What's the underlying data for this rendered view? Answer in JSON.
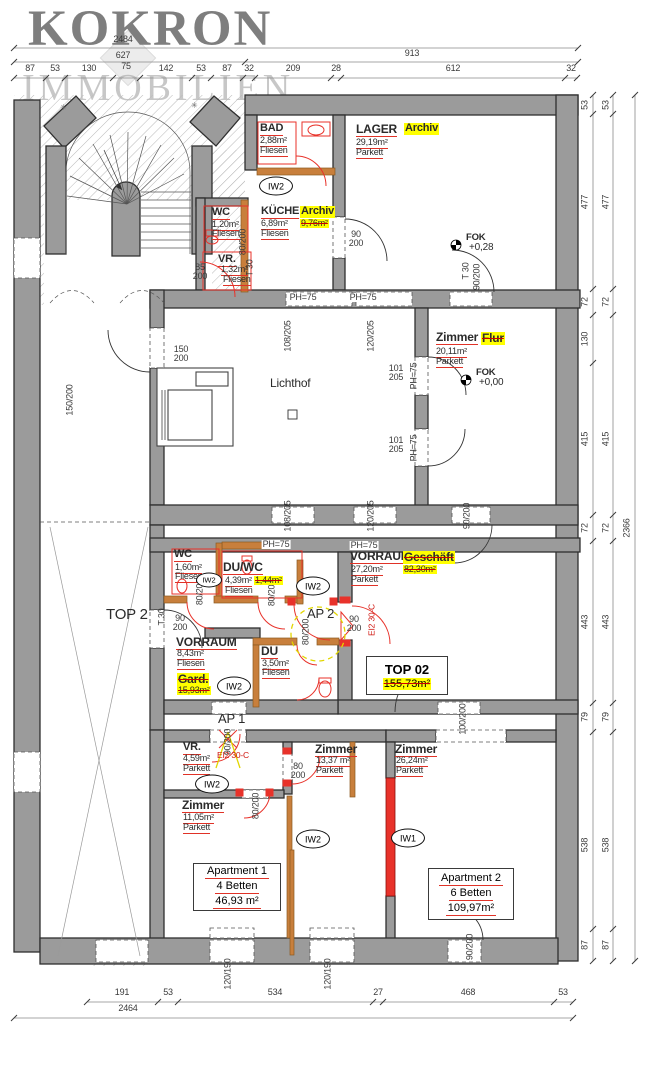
{
  "watermark": {
    "title": "KOKRON",
    "subtitle": "IMMOBILIEN"
  },
  "plan": {
    "colors": {
      "accent_red": "#e03227",
      "highlight_yellow": "#ffff00",
      "wall_gray": "#9b9b9b",
      "orange_wall": "#c87f3c"
    },
    "labels": [
      {
        "n": "dim-total-top",
        "t": "2484",
        "x": 123,
        "y": 35,
        "c": "d"
      },
      {
        "t": "627",
        "x": 123,
        "y": 51,
        "c": "d"
      },
      {
        "t": "913",
        "x": 412,
        "y": 49,
        "c": "d"
      },
      {
        "t": "87",
        "x": 30,
        "y": 64,
        "c": "d"
      },
      {
        "t": "53",
        "x": 55,
        "y": 64,
        "c": "d"
      },
      {
        "t": "130",
        "x": 89,
        "y": 64,
        "c": "d"
      },
      {
        "t": "75",
        "x": 126,
        "y": 62,
        "c": "d"
      },
      {
        "t": "142",
        "x": 166,
        "y": 64,
        "c": "d"
      },
      {
        "t": "53",
        "x": 201,
        "y": 64,
        "c": "d"
      },
      {
        "t": "87",
        "x": 227,
        "y": 64,
        "c": "d"
      },
      {
        "t": "32",
        "x": 249,
        "y": 64,
        "c": "d"
      },
      {
        "t": "209",
        "x": 293,
        "y": 64,
        "c": "d"
      },
      {
        "t": "28",
        "x": 336,
        "y": 64,
        "c": "d"
      },
      {
        "t": "612",
        "x": 453,
        "y": 64,
        "c": "d"
      },
      {
        "t": "32",
        "x": 571,
        "y": 64,
        "c": "d"
      },
      {
        "t": "53",
        "x": 585,
        "y": 105,
        "c": "d",
        "r": -90
      },
      {
        "t": "477",
        "x": 585,
        "y": 202,
        "c": "d",
        "r": -90
      },
      {
        "t": "72",
        "x": 585,
        "y": 302,
        "c": "d",
        "r": -90
      },
      {
        "t": "130",
        "x": 585,
        "y": 339,
        "c": "d",
        "r": -90
      },
      {
        "t": "415",
        "x": 585,
        "y": 439,
        "c": "d",
        "r": -90
      },
      {
        "t": "72",
        "x": 585,
        "y": 528,
        "c": "d",
        "r": -90
      },
      {
        "t": "443",
        "x": 585,
        "y": 622,
        "c": "d",
        "r": -90
      },
      {
        "t": "79",
        "x": 585,
        "y": 717,
        "c": "d",
        "r": -90
      },
      {
        "t": "538",
        "x": 585,
        "y": 845,
        "c": "d",
        "r": -90
      },
      {
        "t": "87",
        "x": 585,
        "y": 945,
        "c": "d",
        "r": -90
      },
      {
        "t": "53",
        "x": 606,
        "y": 105,
        "c": "d",
        "r": -90
      },
      {
        "t": "477",
        "x": 606,
        "y": 202,
        "c": "d",
        "r": -90
      },
      {
        "t": "72",
        "x": 606,
        "y": 302,
        "c": "d",
        "r": -90
      },
      {
        "t": "415",
        "x": 606,
        "y": 439,
        "c": "d",
        "r": -90
      },
      {
        "t": "72",
        "x": 606,
        "y": 528,
        "c": "d",
        "r": -90
      },
      {
        "t": "443",
        "x": 606,
        "y": 622,
        "c": "d",
        "r": -90
      },
      {
        "t": "79",
        "x": 606,
        "y": 717,
        "c": "d",
        "r": -90
      },
      {
        "t": "538",
        "x": 606,
        "y": 845,
        "c": "d",
        "r": -90
      },
      {
        "t": "87",
        "x": 606,
        "y": 945,
        "c": "d",
        "r": -90
      },
      {
        "n": "dim-total-right",
        "t": "2366",
        "x": 627,
        "y": 528,
        "c": "d",
        "r": -90
      },
      {
        "t": "191",
        "x": 122,
        "y": 988,
        "c": "d"
      },
      {
        "t": "53",
        "x": 168,
        "y": 988,
        "c": "d"
      },
      {
        "t": "534",
        "x": 275,
        "y": 988,
        "c": "d"
      },
      {
        "t": "27",
        "x": 378,
        "y": 988,
        "c": "d"
      },
      {
        "t": "468",
        "x": 468,
        "y": 988,
        "c": "d"
      },
      {
        "t": "53",
        "x": 563,
        "y": 988,
        "c": "d"
      },
      {
        "n": "dim-total-bottom",
        "t": "2464",
        "x": 128,
        "y": 1004,
        "c": "d"
      },
      {
        "t": "120/190",
        "x": 228,
        "y": 974,
        "c": "d",
        "r": -90
      },
      {
        "t": "120/190",
        "x": 328,
        "y": 974,
        "c": "d",
        "r": -90
      },
      {
        "t": "90/200",
        "x": 470,
        "y": 947,
        "c": "d",
        "r": -90
      },
      {
        "t": "80/200",
        "x": 243,
        "y": 242,
        "c": "d",
        "r": -90
      },
      {
        "t": "85\n200",
        "x": 200,
        "y": 263,
        "c": "d2"
      },
      {
        "t": "T 30",
        "x": 250,
        "y": 268,
        "c": "d",
        "r": -90
      },
      {
        "t": "90\n200",
        "x": 356,
        "y": 230,
        "c": "d2"
      },
      {
        "t": "T 30",
        "x": 466,
        "y": 271,
        "c": "d",
        "r": -90
      },
      {
        "t": "90/200",
        "x": 477,
        "y": 277,
        "c": "d",
        "r": -90
      },
      {
        "t": "150\n200",
        "x": 181,
        "y": 345,
        "c": "d2"
      },
      {
        "t": "150/200",
        "x": 70,
        "y": 400,
        "c": "d",
        "r": -90
      },
      {
        "t": "PH=75",
        "x": 303,
        "y": 293,
        "c": "ph"
      },
      {
        "t": "PH=75",
        "x": 363,
        "y": 293,
        "c": "ph"
      },
      {
        "t": "108/205",
        "x": 288,
        "y": 336,
        "c": "d",
        "r": -90
      },
      {
        "t": "120/205",
        "x": 371,
        "y": 336,
        "c": "d",
        "r": -90
      },
      {
        "t": "101\n205",
        "x": 396,
        "y": 364,
        "c": "d2"
      },
      {
        "t": "PH=75",
        "x": 414,
        "y": 376,
        "c": "d",
        "r": -90
      },
      {
        "t": "101\n205",
        "x": 396,
        "y": 436,
        "c": "d2"
      },
      {
        "t": "PH=75",
        "x": 414,
        "y": 448,
        "c": "d",
        "r": -90
      },
      {
        "t": "108/205",
        "x": 288,
        "y": 516,
        "c": "d",
        "r": -90
      },
      {
        "t": "120/205",
        "x": 371,
        "y": 516,
        "c": "d",
        "r": -90
      },
      {
        "t": "90/200",
        "x": 467,
        "y": 516,
        "c": "d",
        "r": -90
      },
      {
        "t": "PH=75",
        "x": 276,
        "y": 540,
        "c": "ph"
      },
      {
        "t": "PH=75",
        "x": 364,
        "y": 541,
        "c": "ph"
      },
      {
        "t": "80/200",
        "x": 200,
        "y": 592,
        "c": "d",
        "r": -90
      },
      {
        "t": "80/200",
        "x": 272,
        "y": 593,
        "c": "d",
        "r": -90
      },
      {
        "t": "90\n200",
        "x": 354,
        "y": 615,
        "c": "d2"
      },
      {
        "t": "EI2 30-C",
        "x": 372,
        "y": 620,
        "c": "red",
        "r": -90
      },
      {
        "t": "90\n200",
        "x": 180,
        "y": 614,
        "c": "d2"
      },
      {
        "t": "T 30",
        "x": 162,
        "y": 617,
        "c": "d",
        "r": -90
      },
      {
        "t": "80/200",
        "x": 306,
        "y": 632,
        "c": "d",
        "r": -90
      },
      {
        "t": "100/200",
        "x": 463,
        "y": 719,
        "c": "d",
        "r": -90
      },
      {
        "t": "90/200",
        "x": 228,
        "y": 742,
        "c": "d",
        "r": -90
      },
      {
        "t": "EI2 30-C",
        "x": 233,
        "y": 751,
        "c": "redh"
      },
      {
        "t": "80\n200",
        "x": 298,
        "y": 762,
        "c": "d2"
      },
      {
        "t": "80/200",
        "x": 256,
        "y": 806,
        "c": "d",
        "r": -90
      },
      {
        "n": "room-bad-name",
        "t": "BAD",
        "x": 260,
        "y": 123,
        "c": "rm"
      },
      {
        "t": "2,88m²",
        "x": 260,
        "y": 136,
        "c": "rs"
      },
      {
        "t": "Fliesen",
        "x": 260,
        "y": 146,
        "c": "rs"
      },
      {
        "n": "room-lager-name",
        "t": "LAGER",
        "x": 356,
        "y": 123,
        "c": "rm12"
      },
      {
        "n": "room-lager-newuse",
        "t": "Archiv",
        "x": 404,
        "y": 123,
        "c": "hlb"
      },
      {
        "t": "29,19m²",
        "x": 356,
        "y": 138,
        "c": "rs"
      },
      {
        "t": "Parkett",
        "x": 356,
        "y": 148,
        "c": "rs"
      },
      {
        "n": "room-wc1-name",
        "t": "WC",
        "x": 212,
        "y": 207,
        "c": "rm"
      },
      {
        "t": "1,20m²",
        "x": 212,
        "y": 220,
        "c": "rs"
      },
      {
        "t": "Fliesen",
        "x": 212,
        "y": 229,
        "c": "rs"
      },
      {
        "n": "room-kueche-name",
        "t": "KÜCHE",
        "x": 261,
        "y": 206,
        "c": "rm"
      },
      {
        "n": "room-kueche-newuse",
        "t": "Archiv",
        "x": 300,
        "y": 206,
        "c": "hlb"
      },
      {
        "t": "6,89m²",
        "x": 261,
        "y": 219,
        "c": "rs"
      },
      {
        "t": "9,76m²",
        "x": 300,
        "y": 219,
        "c": "hls"
      },
      {
        "t": "Fliesen",
        "x": 261,
        "y": 229,
        "c": "rs"
      },
      {
        "n": "room-vr1-name",
        "t": "VR.",
        "x": 218,
        "y": 254,
        "c": "rm"
      },
      {
        "t": "1,32m²",
        "x": 221,
        "y": 265,
        "c": "rs"
      },
      {
        "t": "Fliesen",
        "x": 223,
        "y": 275,
        "c": "rs"
      },
      {
        "n": "room-zimmer-flur-name",
        "t": "Zimmer",
        "x": 436,
        "y": 331,
        "c": "rm12"
      },
      {
        "n": "room-zimmer-flur-newuse",
        "t": "Flur",
        "x": 481,
        "y": 332,
        "c": "hlsb"
      },
      {
        "t": "20,11m²",
        "x": 436,
        "y": 347,
        "c": "rs"
      },
      {
        "t": "Parkett",
        "x": 436,
        "y": 357,
        "c": "rs"
      },
      {
        "n": "lichthof-label",
        "t": "Lichthof",
        "x": 270,
        "y": 377,
        "c": "lh"
      },
      {
        "t": "FOK",
        "x": 466,
        "y": 233,
        "c": "fok"
      },
      {
        "t": "+0,28",
        "x": 469,
        "y": 243,
        "c": "fok2"
      },
      {
        "t": "FOK",
        "x": 476,
        "y": 368,
        "c": "fok"
      },
      {
        "t": "+0,00",
        "x": 479,
        "y": 378,
        "c": "fok2"
      },
      {
        "n": "room-wc2-name",
        "t": "WC",
        "x": 174,
        "y": 549,
        "c": "rm"
      },
      {
        "t": "1,60m²",
        "x": 175,
        "y": 563,
        "c": "rs"
      },
      {
        "t": "Fliesen",
        "x": 175,
        "y": 572,
        "c": "rs"
      },
      {
        "n": "room-duwc-name",
        "t": "DU/WC",
        "x": 223,
        "y": 561,
        "c": "rm12"
      },
      {
        "t": "4,39m²",
        "x": 225,
        "y": 576,
        "c": "rs"
      },
      {
        "t": "1,44m²",
        "x": 254,
        "y": 576,
        "c": "hls"
      },
      {
        "t": "Fliesen",
        "x": 225,
        "y": 586,
        "c": "rs"
      },
      {
        "n": "room-vorraum1-name",
        "t": "VORRAUM",
        "x": 350,
        "y": 550,
        "c": "rm12"
      },
      {
        "n": "room-vorraum1-newuse",
        "t": "Geschäft",
        "x": 403,
        "y": 551,
        "c": "hlsb"
      },
      {
        "t": "27,20m²",
        "x": 351,
        "y": 565,
        "c": "rs"
      },
      {
        "t": "82,30m²",
        "x": 403,
        "y": 565,
        "c": "hls"
      },
      {
        "t": "Parkett",
        "x": 351,
        "y": 575,
        "c": "rs"
      },
      {
        "n": "ap2-label",
        "t": "AP 2",
        "x": 307,
        "y": 607,
        "c": "ap"
      },
      {
        "n": "top2-label",
        "t": "TOP 2",
        "x": 106,
        "y": 607,
        "c": "big"
      },
      {
        "n": "room-vorraum2-name",
        "t": "VORRAUM",
        "x": 176,
        "y": 636,
        "c": "rm12"
      },
      {
        "t": "8,43m²",
        "x": 177,
        "y": 649,
        "c": "rs"
      },
      {
        "t": "Fliesen",
        "x": 177,
        "y": 659,
        "c": "rs"
      },
      {
        "n": "room-vorraum2-newuse",
        "t": "Gard.",
        "x": 177,
        "y": 673,
        "c": "hlsb"
      },
      {
        "t": "15,93m²",
        "x": 177,
        "y": 686,
        "c": "hls"
      },
      {
        "n": "room-du-name",
        "t": "DU",
        "x": 261,
        "y": 645,
        "c": "rm12"
      },
      {
        "t": "3,50m²",
        "x": 262,
        "y": 659,
        "c": "rs"
      },
      {
        "t": "Fliesen",
        "x": 262,
        "y": 668,
        "c": "rs"
      },
      {
        "n": "ap1-label",
        "t": "AP 1",
        "x": 218,
        "y": 712,
        "c": "ap"
      },
      {
        "n": "room-vr2-name",
        "t": "VR.",
        "x": 183,
        "y": 742,
        "c": "rm"
      },
      {
        "t": "4,59m²",
        "x": 183,
        "y": 754,
        "c": "rs"
      },
      {
        "t": "Parkett",
        "x": 183,
        "y": 764,
        "c": "rs"
      },
      {
        "n": "room-zimmer1337-name",
        "t": "Zimmer",
        "x": 315,
        "y": 743,
        "c": "rm12"
      },
      {
        "t": "13,37 m²",
        "x": 316,
        "y": 756,
        "c": "rs"
      },
      {
        "t": "Parkett",
        "x": 316,
        "y": 766,
        "c": "rs"
      },
      {
        "n": "room-zimmer1105-name",
        "t": "Zimmer",
        "x": 182,
        "y": 799,
        "c": "rm12"
      },
      {
        "t": "11,05m²",
        "x": 183,
        "y": 813,
        "c": "rs"
      },
      {
        "t": "Parkett",
        "x": 183,
        "y": 823,
        "c": "rs"
      },
      {
        "n": "room-zimmer2624-name",
        "t": "Zimmer",
        "x": 395,
        "y": 743,
        "c": "rm12"
      },
      {
        "t": "26,24m²",
        "x": 396,
        "y": 756,
        "c": "rs"
      },
      {
        "t": "Parkett",
        "x": 396,
        "y": 766,
        "c": "rs"
      },
      {
        "t": "✳",
        "x": 60,
        "y": 104,
        "c": "star"
      },
      {
        "t": "✳",
        "x": 191,
        "y": 102,
        "c": "star"
      }
    ],
    "ovals": [
      {
        "t": "IW2",
        "x": 276,
        "y": 186
      },
      {
        "t": "IW2",
        "x": 209,
        "y": 580,
        "sm": 1
      },
      {
        "t": "IW2",
        "x": 313,
        "y": 586
      },
      {
        "t": "IW2",
        "x": 234,
        "y": 686
      },
      {
        "t": "IW2",
        "x": 212,
        "y": 784
      },
      {
        "t": "IW2",
        "x": 313,
        "y": 839
      },
      {
        "t": "IW1",
        "x": 408,
        "y": 838
      }
    ],
    "boxes": [
      {
        "n": "top02-box",
        "x": 366,
        "y": 656,
        "w": 80,
        "h": 37,
        "lines": [
          {
            "t": "TOP 02",
            "c": "bt"
          },
          {
            "t": "155,73m²",
            "c": "hls2"
          }
        ]
      },
      {
        "n": "apartment1-box",
        "x": 193,
        "y": 863,
        "w": 86,
        "h": 46,
        "lines": [
          {
            "t": "Apartment 1",
            "c": "ab"
          },
          {
            "t": "4 Betten",
            "c": "ab"
          },
          {
            "t": "46,93 m²",
            "c": "ab"
          }
        ]
      },
      {
        "n": "apartment2-box",
        "x": 428,
        "y": 868,
        "w": 84,
        "h": 50,
        "lines": [
          {
            "t": "Apartment 2",
            "c": "ab"
          },
          {
            "t": "6 Betten",
            "c": "ab"
          },
          {
            "t": "109,97m²",
            "c": "ab"
          }
        ]
      }
    ]
  }
}
